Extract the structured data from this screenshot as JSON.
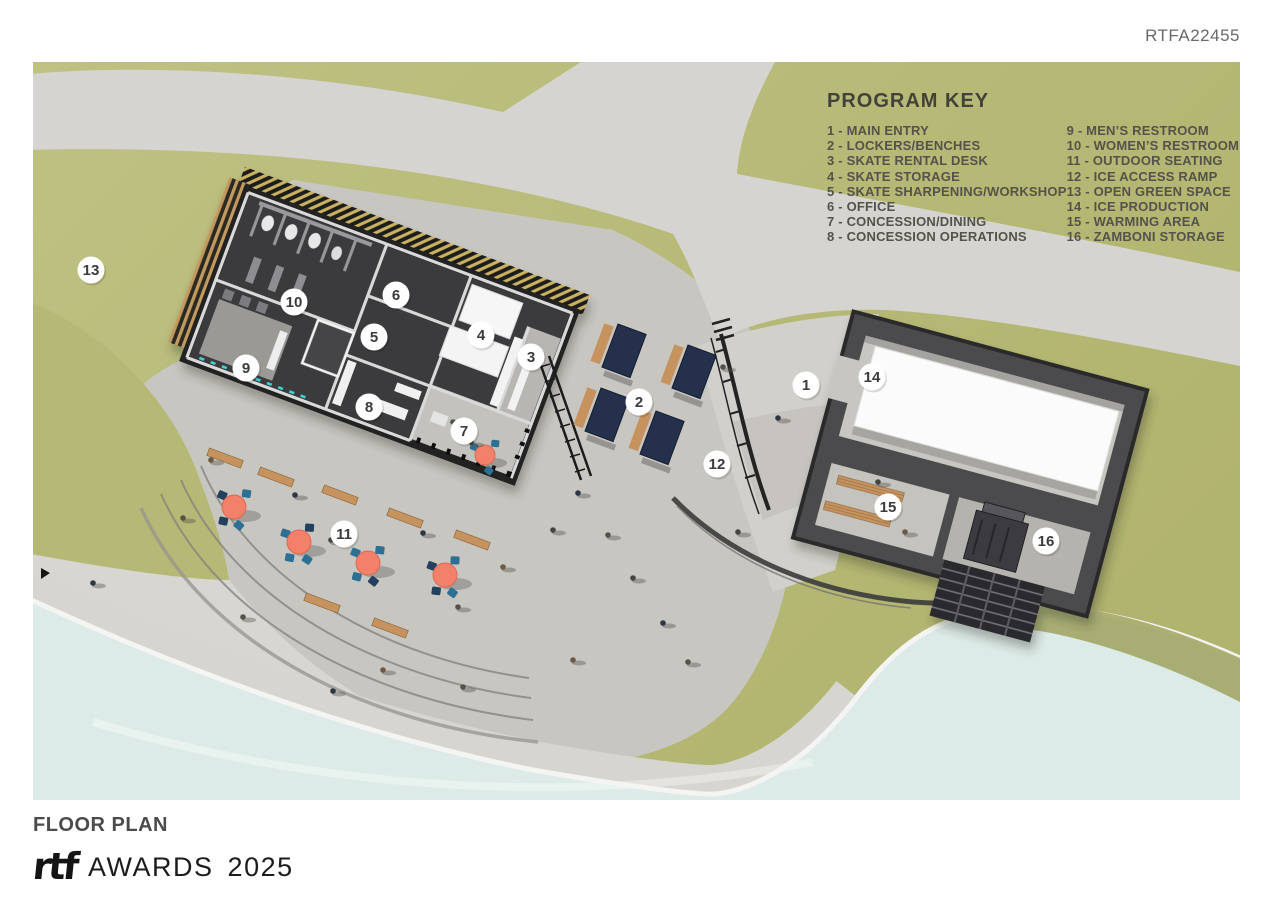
{
  "header": {
    "code": "RTFA22455"
  },
  "program_key": {
    "title": "PROGRAM KEY",
    "column1": [
      "1 - MAIN ENTRY",
      "2 - LOCKERS/BENCHES",
      "3 - SKATE RENTAL DESK",
      "4 - SKATE STORAGE",
      "5 - SKATE SHARPENING/WORKSHOP",
      "6 - OFFICE",
      "7 - CONCESSION/DINING",
      "8 - CONCESSION OPERATIONS"
    ],
    "column2": [
      "9 - MEN’S RESTROOM",
      "10 - WOMEN’S RESTROOM",
      "11 - OUTDOOR SEATING",
      "12 - ICE ACCESS RAMP",
      "13 - OPEN GREEN SPACE",
      "14 - ICE PRODUCTION",
      "15 - WARMING AREA",
      "16 - ZAMBONI STORAGE"
    ]
  },
  "markers": [
    "1",
    "2",
    "3",
    "4",
    "5",
    "6",
    "7",
    "8",
    "9",
    "10",
    "11",
    "12",
    "13",
    "14",
    "15",
    "16"
  ],
  "footer": {
    "plan_title": "FLOOR PLAN",
    "logo_text": "rtf",
    "awards_label": "AWARDS",
    "year": "2025"
  },
  "colors": {
    "grass": "#b8bb79",
    "walkway": "#d6d4d0",
    "plaza": "#c8c6c1",
    "ice": "#dcebe7",
    "building_dark": "#3a3a3c",
    "roof_white": "#fbfbfb",
    "table_coral": "#f2806a",
    "chair_teal": "#2d7093",
    "locker_navy": "#24304c",
    "bench_wood": "#c6935e",
    "hatch_gold": "#c9b362",
    "wall_light_teal": "#40d6d6"
  }
}
